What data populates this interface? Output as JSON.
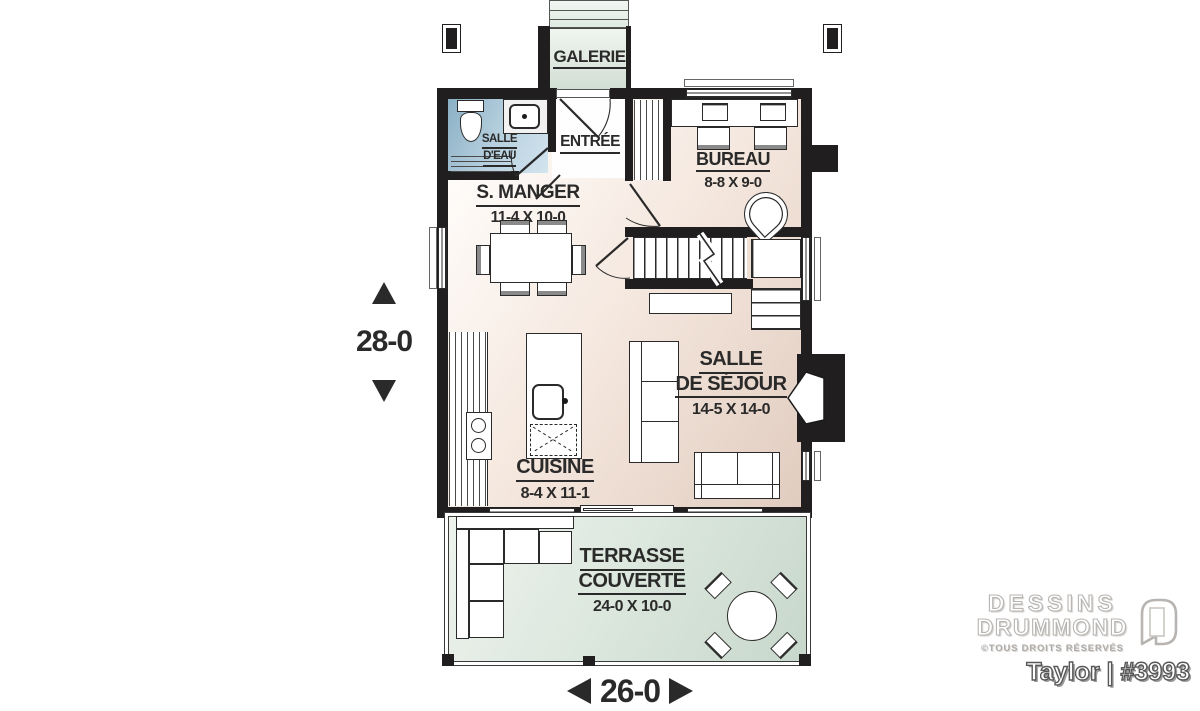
{
  "plan": {
    "brand_line1": "DESSINS",
    "brand_line2": "DRUMMOND",
    "rights": "©TOUS DROITS RÉSERVÉS",
    "title": "Taylor | #3993"
  },
  "dimensions": {
    "depth": "28-0",
    "width": "26-0"
  },
  "rooms": {
    "galerie": {
      "name": "GALERIE"
    },
    "salle_deau": {
      "name_line1": "SALLE",
      "name_line2": "D'EAU"
    },
    "entree": {
      "name": "ENTRÉE"
    },
    "bureau": {
      "name": "BUREAU",
      "dims": "8-8 X 9-0"
    },
    "salle_a_manger": {
      "name": "S. MANGER",
      "dims": "11-4 X 10-0"
    },
    "cuisine": {
      "name": "CUISINE",
      "dims": "8-4 X 11-1"
    },
    "salle_de_sejour": {
      "name_line1": "SALLE",
      "name_line2": "DE SÉJOUR",
      "dims": "14-5 X 14-0"
    },
    "terrasse": {
      "name_line1": "TERRASSE",
      "name_line2": "COUVERTE",
      "dims": "24-0 X 10-0"
    }
  },
  "colors": {
    "wall": "#211e1f",
    "floor_light": "#fffdfb",
    "floor_dark": "#e0cbbe",
    "water_dark": "#8aafc4",
    "water_light": "#d3e4ee",
    "outdoor_light": "#eef3ee",
    "outdoor_dark": "#c7d7cb",
    "label": "#2b2a2a"
  }
}
